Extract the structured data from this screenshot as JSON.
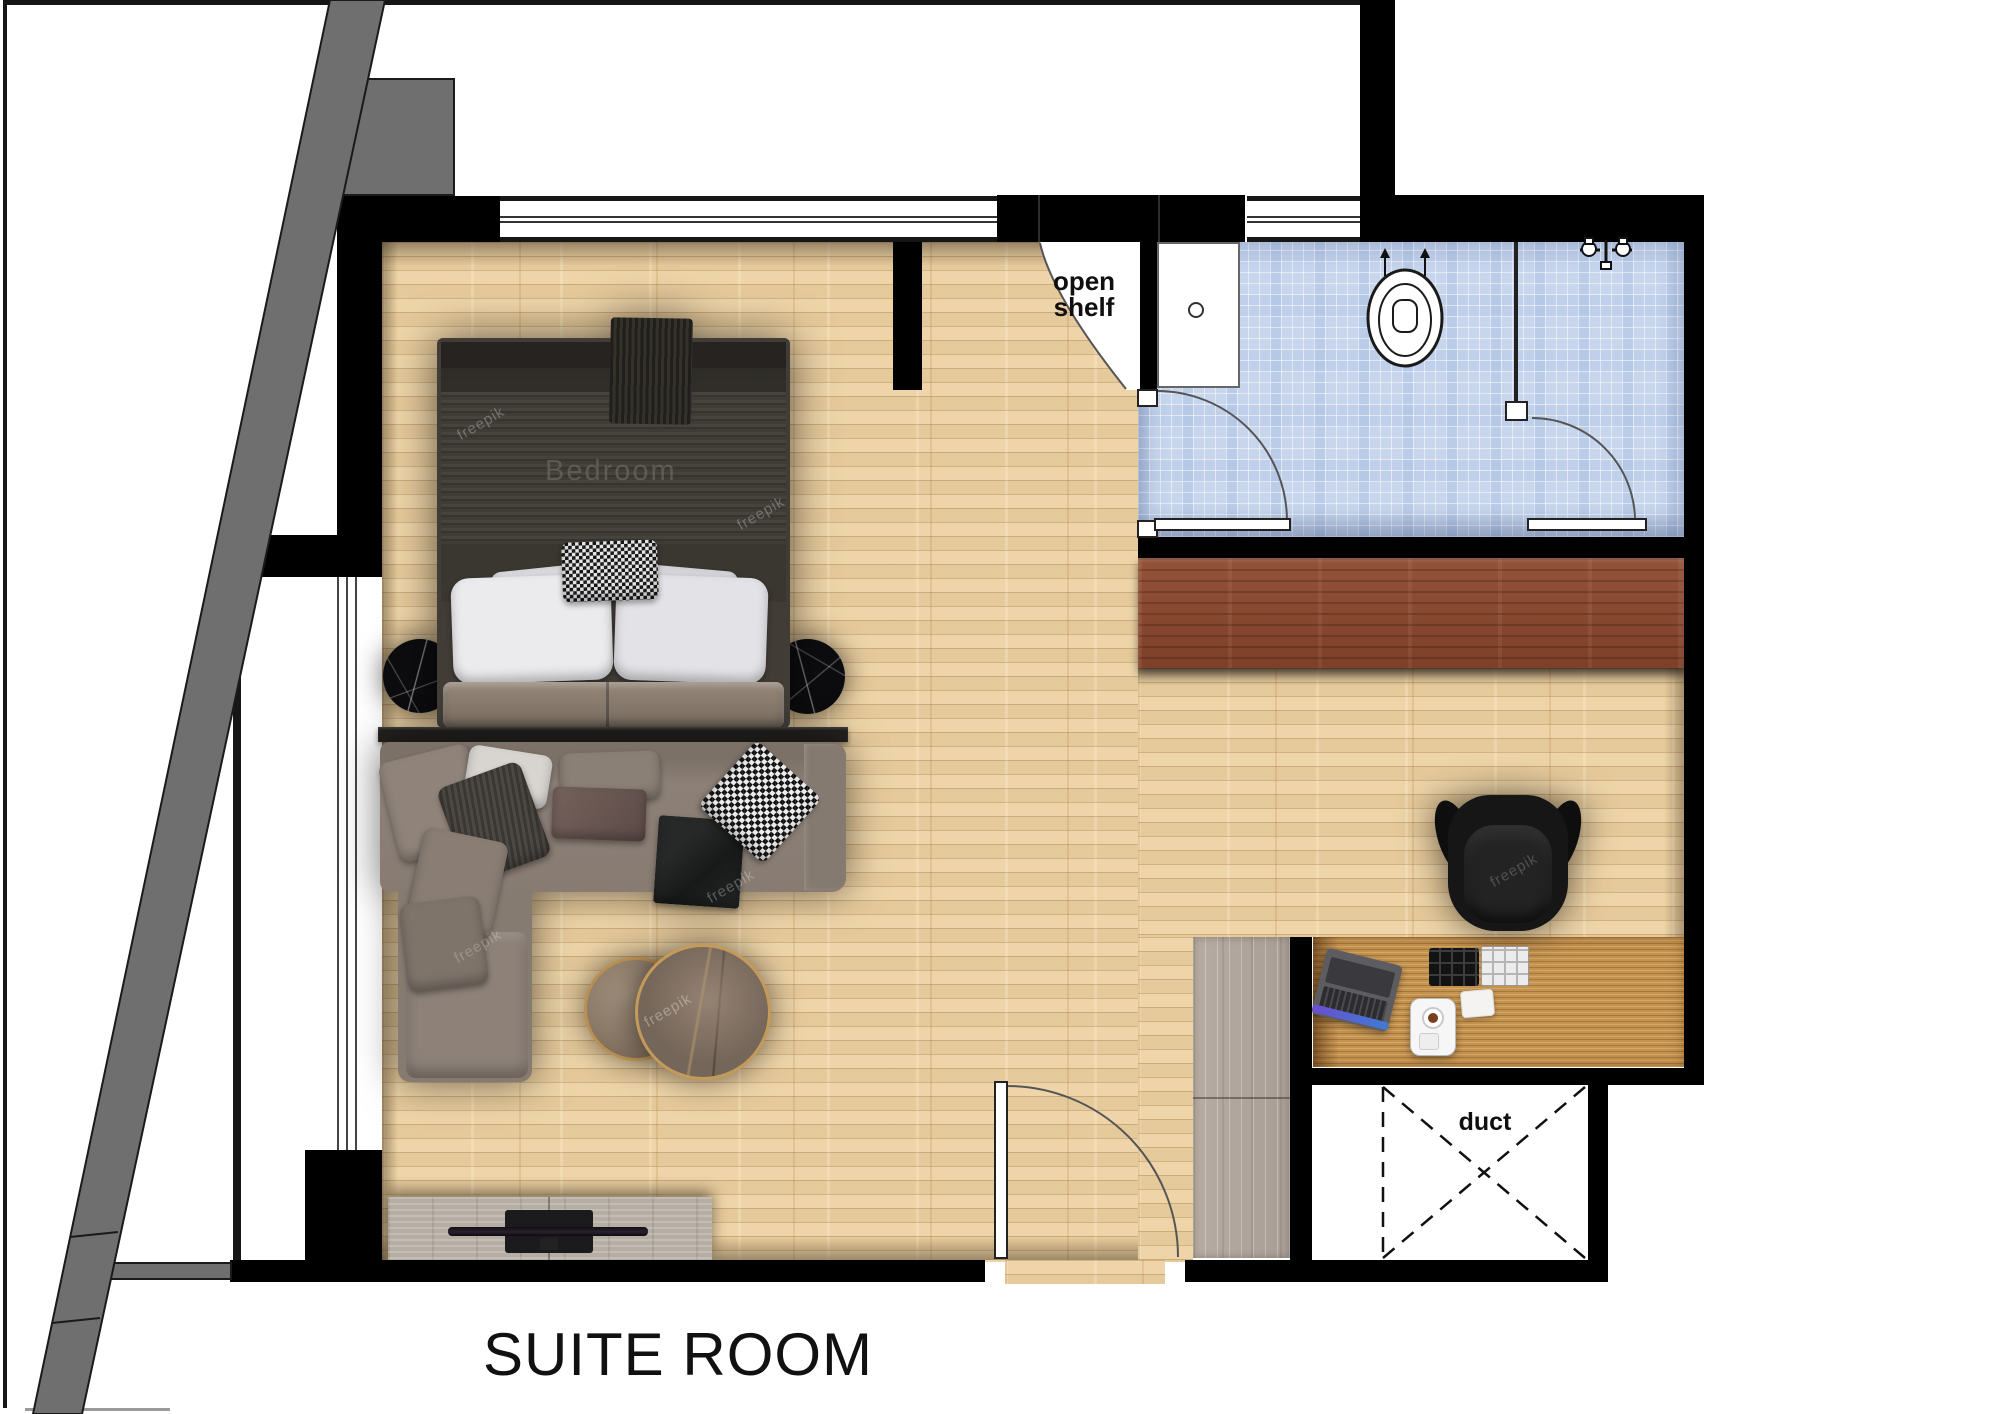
{
  "title": {
    "text": "SUITE ROOM"
  },
  "labels": {
    "open_shelf": "open shelf",
    "duct": "duct"
  },
  "watermarks": {
    "room_label": "Bedroom",
    "brand": "freepik"
  },
  "colors": {
    "wall": "#000000",
    "floor_wood": "#ecd1a2",
    "bathroom_tile": "#c7d6ed",
    "wardrobe_wood": "#8a4a31",
    "desk_wood": "#c49350",
    "cabinet_wood": "#b1a79e",
    "tv_console_wood": "#b6aea4",
    "structure_gray": "#6f6f6f",
    "sofa_fabric": "#8c8077",
    "bed_duvet": "#34312c"
  }
}
